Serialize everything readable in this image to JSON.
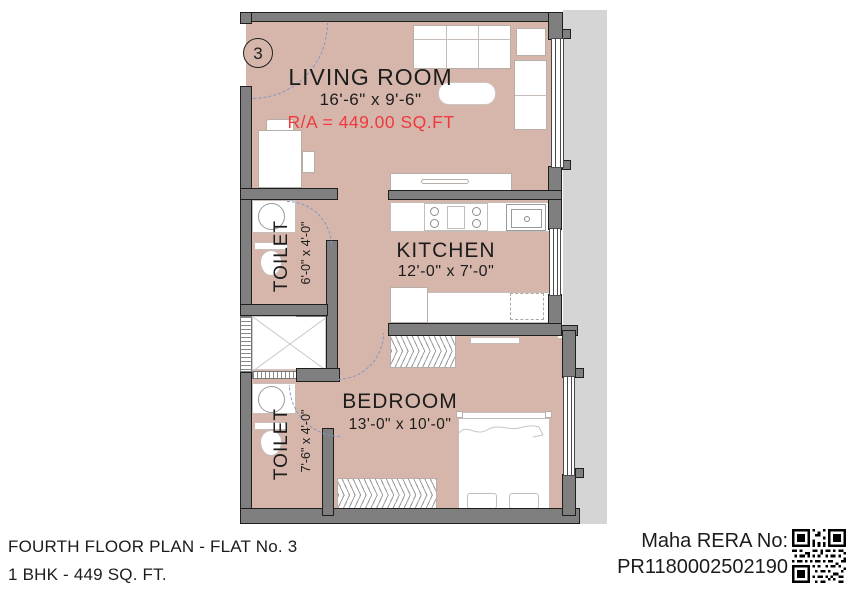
{
  "plan": {
    "flat_badge": "3",
    "rooms": {
      "living_room": {
        "name": "LIVING ROOM",
        "dims": "16'-6\" x 9'-6\"",
        "area": "R/A = 449.00 SQ.FT"
      },
      "kitchen": {
        "name": "KITCHEN",
        "dims": "12'-0\" x 7'-0\""
      },
      "bedroom": {
        "name": "BEDROOM",
        "dims": "13'-0\" x 10'-0\""
      },
      "toilet_upper": {
        "name": "TOILET",
        "dims": "6'-0\" x 4'-0\""
      },
      "toilet_lower": {
        "name": "TOILET",
        "dims": "7'-6\" x 4'-0\""
      }
    },
    "colors": {
      "floor": "#d6b6ab",
      "wall": "#7f7f7f",
      "area_text": "#ee3a3e",
      "door_arc": "#7d97c6",
      "exterior_band": "#d5d5d5"
    }
  },
  "footer": {
    "plan_title": "FOURTH FLOOR PLAN - FLAT No. 3",
    "plan_subtitle": "1 BHK - 449 SQ. FT.",
    "rera_label": "Maha RERA  No:",
    "rera_number": "PR1180002502190"
  }
}
